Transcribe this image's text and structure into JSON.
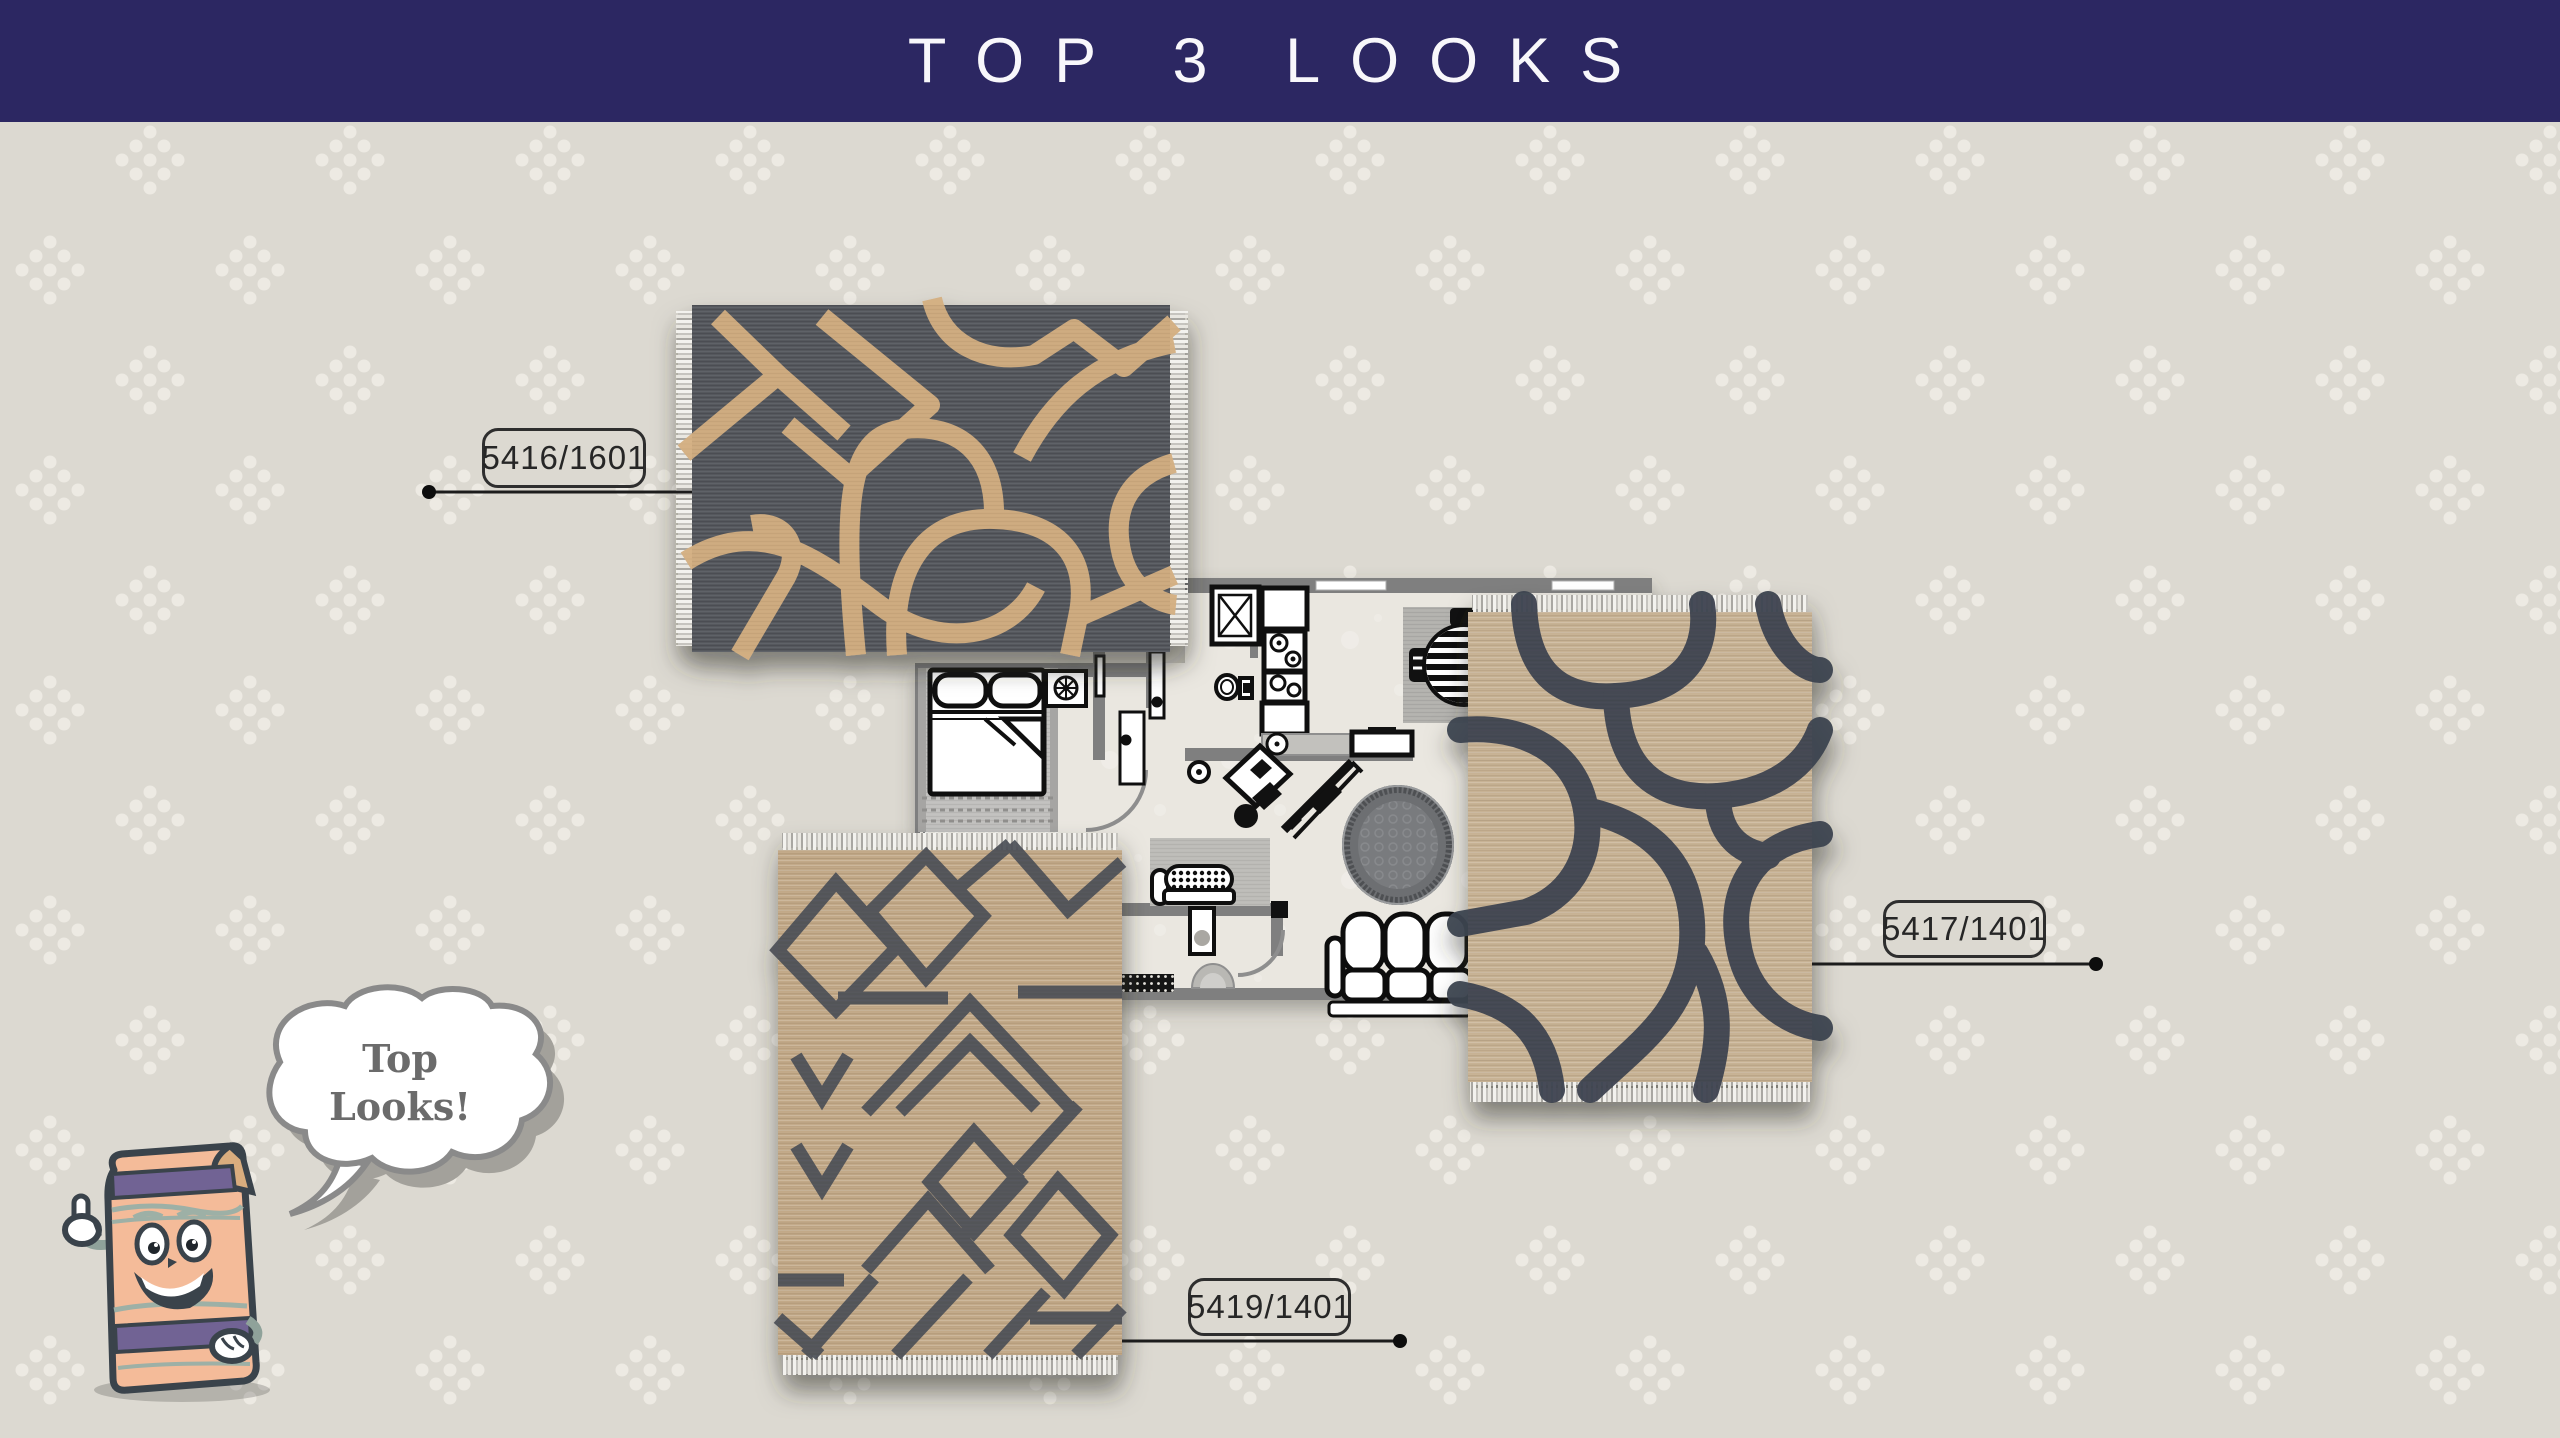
{
  "header": {
    "title": "TOP 3 LOOKS",
    "background_color": "#2c2762",
    "text_color": "#f8f7fb"
  },
  "page": {
    "background_color": "#dcd9d1",
    "pattern_dot_color": "#edeae3"
  },
  "rugs": [
    {
      "code": "5416/1601",
      "position": "top-left",
      "orientation": "landscape",
      "base_color": "#55585d",
      "pattern_color": "#d4af81",
      "description": "charcoal rug with tan abstract lines"
    },
    {
      "code": "5417/1401",
      "position": "right",
      "orientation": "portrait",
      "base_color": "#c7b294",
      "pattern_color": "#3e4450",
      "description": "tan rug with charcoal abstract lines"
    },
    {
      "code": "5419/1401",
      "position": "bottom-left",
      "orientation": "portrait",
      "base_color": "#c2a988",
      "pattern_color": "#4b4f57",
      "description": "tan rug with charcoal tribal chevrons and diamonds"
    }
  ],
  "callouts": {
    "line_color": "#1c1c1c",
    "box_border_color": "#2e2e2e",
    "text_color": "#262626"
  },
  "mascot": {
    "character": "rolled-rug-thumbs-up",
    "speech_lines": [
      "Top",
      "Looks!"
    ],
    "speech_text_color": "#6b6b6b"
  },
  "floorplan": {
    "rooms": [
      "bedroom",
      "bathroom",
      "kitchen",
      "dining-area",
      "living-area",
      "entry"
    ],
    "furniture": [
      "double-bed",
      "nightstand",
      "wardrobe-doors",
      "shower",
      "toilet",
      "fridge",
      "stove",
      "kitchen-sink",
      "kitchen-counter",
      "kitchen-island",
      "dining-table",
      "dining-chair",
      "desk",
      "desk-chair",
      "stool",
      "chaise",
      "round-ornate-rug",
      "three-seat-sofa",
      "tufted-bench",
      "console-table",
      "doormat",
      "bedroom-rug",
      "living-rug",
      "windows",
      "door-arcs"
    ]
  }
}
